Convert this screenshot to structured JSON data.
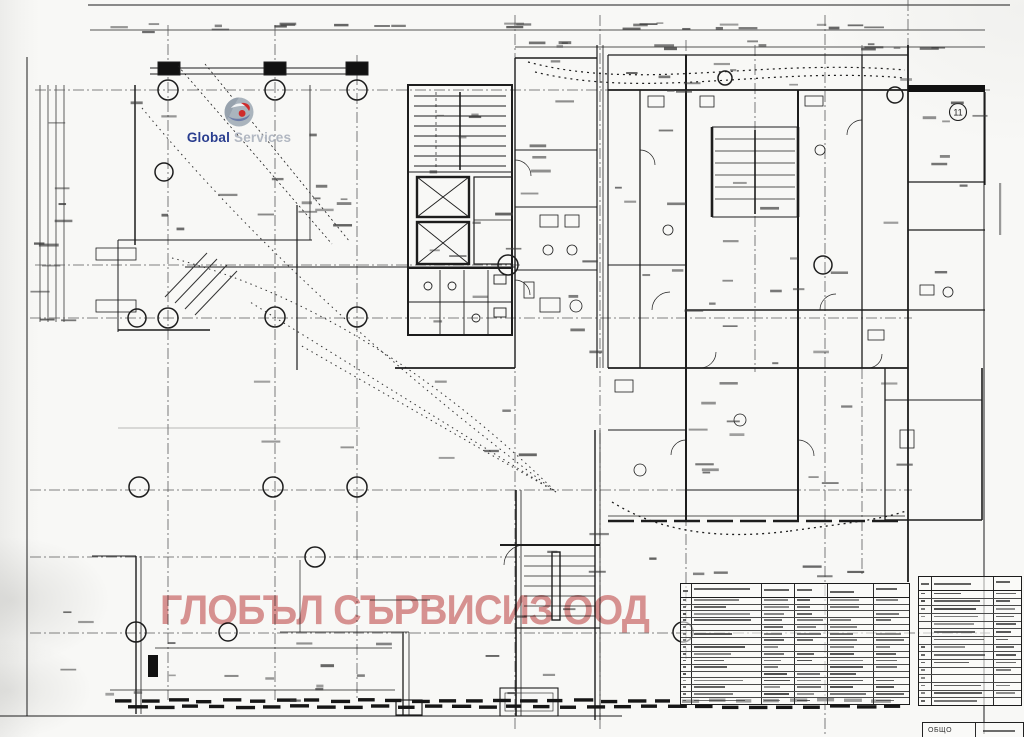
{
  "logo": {
    "word1": "Global",
    "word2": "Services",
    "word1_color": "#2a3e8f",
    "word2_color": "#b2b8c2",
    "icon": "globe-swoosh-icon"
  },
  "watermark": {
    "text": "ГЛОБЪЛ СЪРВИСИЗ ООД",
    "color": "rgba(197,78,78,0.60)"
  },
  "plan": {
    "room_badge": "11",
    "ink_color": "#1d1d1d",
    "axis_color": "#5a5a5a"
  },
  "tables": {
    "left": {
      "x": 680,
      "y": 583,
      "w": 228,
      "h": 120,
      "header_h": 13,
      "rows": 16,
      "col_offsets": [
        10,
        80,
        113,
        146,
        192
      ]
    },
    "right": {
      "x": 918,
      "y": 576,
      "w": 102,
      "h": 128,
      "header_h": 13,
      "rows": 15,
      "col_offsets": [
        12,
        74
      ]
    },
    "totals": {
      "label": "ОБЩО"
    }
  }
}
